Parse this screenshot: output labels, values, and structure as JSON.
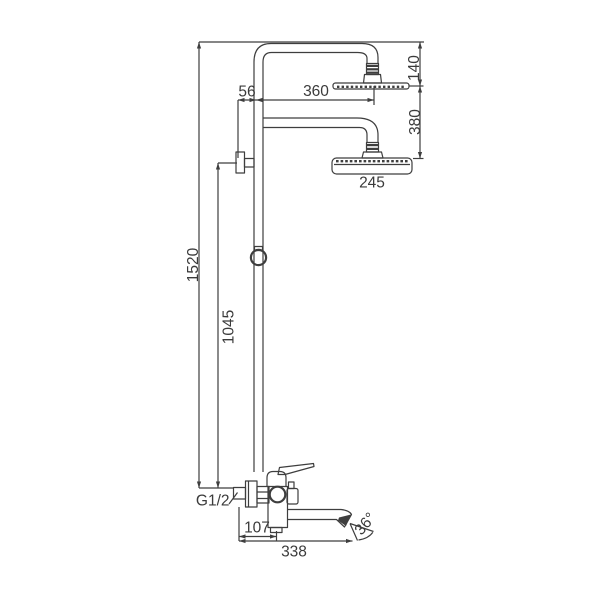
{
  "ink": "#3e3e3e",
  "background": "#ffffff",
  "dimensions": {
    "overall_height": "1520",
    "riser_height": "1045",
    "rain_head_drop": "140",
    "rain_head_reach": "360",
    "wall_offset": "56",
    "heads_gap": "380",
    "hand_head_width": "245",
    "spout_wall_offset": "107",
    "spout_reach": "338",
    "spout_swivel_angle": "36°",
    "inlet_connection": "G1/2"
  }
}
